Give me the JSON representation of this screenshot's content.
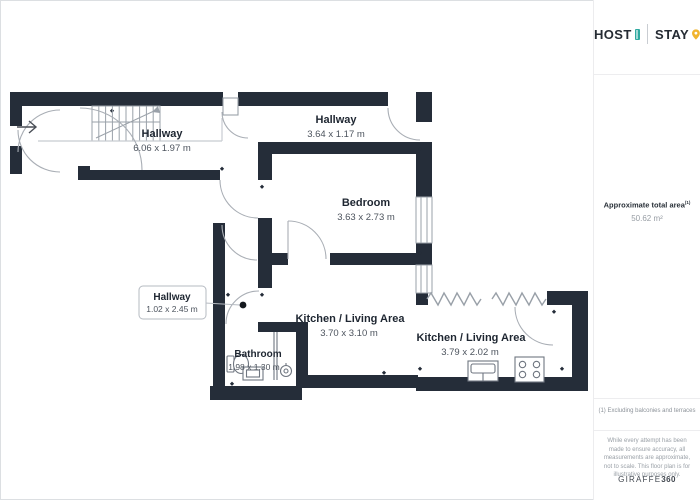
{
  "colors": {
    "wall": "#252d39",
    "accent_teal": "#2fa9a0",
    "accent_yellow": "#f1b42e"
  },
  "plan": {
    "rooms": [
      {
        "name": "Hallway",
        "dims": "6.06 x 1.97 m"
      },
      {
        "name": "Hallway",
        "dims": "3.64 x 1.17 m"
      },
      {
        "name": "Bedroom",
        "dims": "3.63 x 2.73 m"
      },
      {
        "name": "Hallway",
        "dims": "1.02 x 2.45 m"
      },
      {
        "name": "Kitchen / Living Area",
        "dims": "3.70 x 3.10 m"
      },
      {
        "name": "Bathroom",
        "dims": "1.98 x 1.30 m"
      },
      {
        "name": "Kitchen / Living Area",
        "dims": "3.79 x 2.02 m"
      }
    ],
    "icons": [
      "entry-arrow-icon",
      "stairs",
      "door-arc",
      "window",
      "removed-wall-zigzag",
      "toilet",
      "washbasin",
      "vanity",
      "sink",
      "stove"
    ]
  },
  "sidebar": {
    "logo": {
      "host": "HOST",
      "stay": "STAY"
    },
    "area_label": "Approximate total area",
    "area_sup": "(1)",
    "area_value": "50.62 m²",
    "footnote": "(1) Excluding balconies and terraces",
    "disclaimer": "While every attempt has been made to ensure accuracy, all measurements are approximate, not to scale. This floor plan is for illustrative purposes only.",
    "brand": "GIRAFFE",
    "brand_bold": "360"
  }
}
